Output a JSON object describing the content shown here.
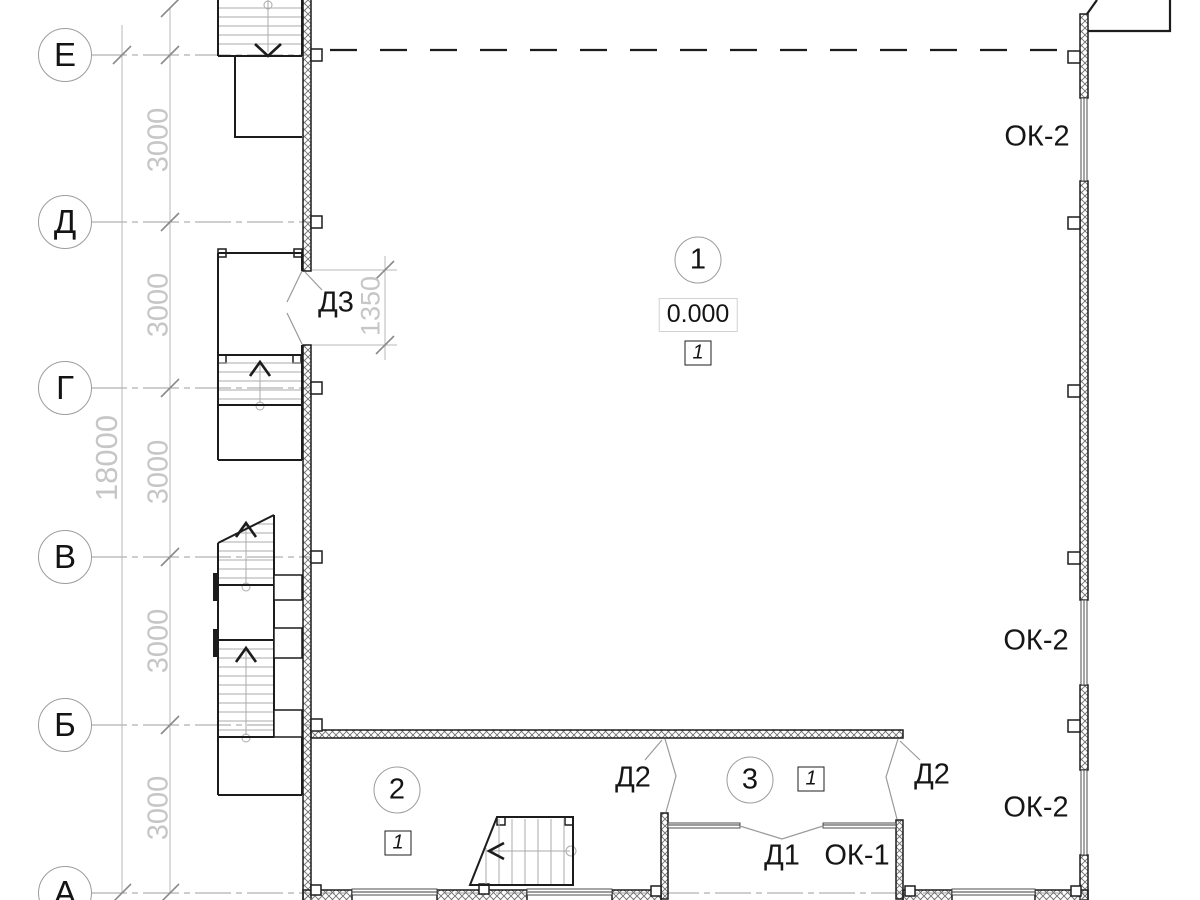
{
  "axes": [
    "Е",
    "Д",
    "Г",
    "В",
    "Б",
    "А"
  ],
  "dims": {
    "overall": "18000",
    "bays": [
      "3000",
      "3000",
      "3000",
      "3000",
      "3000"
    ],
    "door_opening": "1350"
  },
  "rooms": [
    {
      "number": "1",
      "level": "0.000",
      "finish_mark": "1"
    },
    {
      "number": "2",
      "finish_mark": "1"
    },
    {
      "number": "3",
      "finish_mark": "1"
    }
  ],
  "doors": {
    "d3": "Д3",
    "d2_left": "Д2",
    "d2_right": "Д2",
    "d1": "Д1"
  },
  "windows": {
    "ok2_top": "ОК-2",
    "ok2_middle": "ОК-2",
    "ok2_bottom": "ОК-2",
    "ok1": "ОК-1"
  },
  "colors": {
    "line": "#1c1c1c",
    "axis_line": "#9c9c9c",
    "dim_text": "#c6c6c6"
  }
}
